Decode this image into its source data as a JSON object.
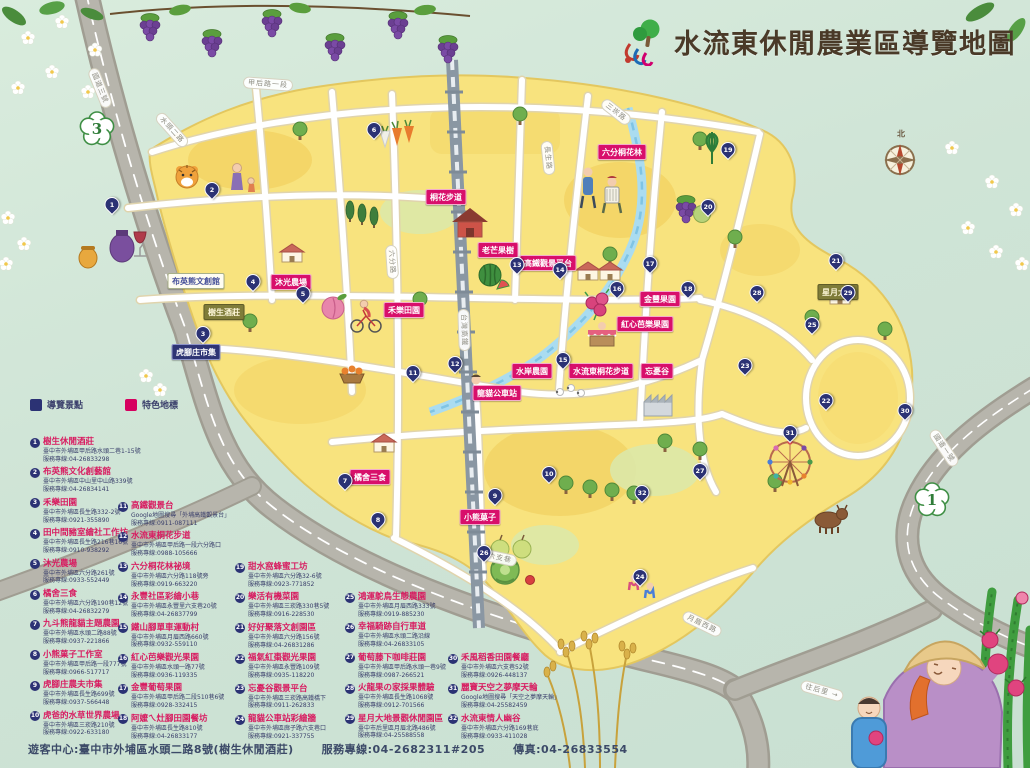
{
  "header": {
    "title": "水流東休閒農業區導覽地圖",
    "logo": "tree-and-water-swirl-logo"
  },
  "compass": {
    "north_label": "北"
  },
  "highway_shields": [
    {
      "num": "3",
      "x": 97,
      "y": 129
    },
    {
      "num": "1",
      "x": 932,
      "y": 500
    }
  ],
  "road_labels": [
    {
      "text": "國道三號",
      "x": 100,
      "y": 88,
      "rot": 68
    },
    {
      "text": "甲后路一段",
      "x": 268,
      "y": 84,
      "rot": 4
    },
    {
      "text": "水頭二路",
      "x": 172,
      "y": 130,
      "rot": 48
    },
    {
      "text": "六分路",
      "x": 392,
      "y": 262,
      "rot": 86
    },
    {
      "text": "長生路",
      "x": 548,
      "y": 158,
      "rot": 84
    },
    {
      "text": "三崁路",
      "x": 616,
      "y": 112,
      "rot": 38
    },
    {
      "text": "台灣高鐵",
      "x": 464,
      "y": 330,
      "rot": 88
    },
    {
      "text": "六支巷",
      "x": 500,
      "y": 558,
      "rot": 12
    },
    {
      "text": "月眉西路",
      "x": 702,
      "y": 624,
      "rot": 26
    },
    {
      "text": "往后里 →",
      "x": 822,
      "y": 691,
      "rot": 16
    },
    {
      "text": "國道一號",
      "x": 944,
      "y": 448,
      "rot": 56
    }
  ],
  "map_labels": [
    {
      "text": "布英熊文創館",
      "x": 196,
      "y": 281,
      "style": "white"
    },
    {
      "text": "樹生酒莊",
      "x": 224,
      "y": 312,
      "style": "olive"
    },
    {
      "text": "虎腳庄市集",
      "x": 196,
      "y": 352,
      "style": "navy"
    },
    {
      "text": "沐光農場",
      "x": 291,
      "y": 282,
      "style": "pink"
    },
    {
      "text": "禾樂田園",
      "x": 404,
      "y": 310,
      "style": "pink"
    },
    {
      "text": "桐花步道",
      "x": 446,
      "y": 197,
      "style": "pink"
    },
    {
      "text": "老芒果樹",
      "x": 498,
      "y": 250,
      "style": "pink"
    },
    {
      "text": "高鐵觀景平台",
      "x": 548,
      "y": 263,
      "style": "pink"
    },
    {
      "text": "六分桐花林",
      "x": 622,
      "y": 152,
      "style": "pink"
    },
    {
      "text": "金豐果園",
      "x": 660,
      "y": 299,
      "style": "pink"
    },
    {
      "text": "紅心芭樂果園",
      "x": 645,
      "y": 324,
      "style": "pink"
    },
    {
      "text": "水岸農園",
      "x": 532,
      "y": 371,
      "style": "pink"
    },
    {
      "text": "水流東桐花步道",
      "x": 601,
      "y": 371,
      "style": "pink"
    },
    {
      "text": "忘憂谷",
      "x": 657,
      "y": 371,
      "style": "pink"
    },
    {
      "text": "龍貓公車站",
      "x": 497,
      "y": 393,
      "style": "pink"
    },
    {
      "text": "橘舍三食",
      "x": 370,
      "y": 477,
      "style": "pink"
    },
    {
      "text": "小熊菓子",
      "x": 480,
      "y": 517,
      "style": "pink"
    },
    {
      "text": "星月大地",
      "x": 838,
      "y": 292,
      "style": "olive"
    }
  ],
  "pins": [
    {
      "n": 1,
      "x": 112,
      "y": 212
    },
    {
      "n": 2,
      "x": 212,
      "y": 197
    },
    {
      "n": 3,
      "x": 203,
      "y": 341
    },
    {
      "n": 4,
      "x": 253,
      "y": 289
    },
    {
      "n": 5,
      "x": 303,
      "y": 301
    },
    {
      "n": 6,
      "x": 374,
      "y": 137
    },
    {
      "n": 7,
      "x": 345,
      "y": 488
    },
    {
      "n": 8,
      "x": 378,
      "y": 527
    },
    {
      "n": 9,
      "x": 495,
      "y": 503
    },
    {
      "n": 10,
      "x": 549,
      "y": 481
    },
    {
      "n": 11,
      "x": 413,
      "y": 380
    },
    {
      "n": 12,
      "x": 455,
      "y": 371
    },
    {
      "n": 13,
      "x": 517,
      "y": 272
    },
    {
      "n": 14,
      "x": 560,
      "y": 277
    },
    {
      "n": 15,
      "x": 563,
      "y": 367
    },
    {
      "n": 16,
      "x": 617,
      "y": 296
    },
    {
      "n": 17,
      "x": 650,
      "y": 271
    },
    {
      "n": 18,
      "x": 688,
      "y": 296
    },
    {
      "n": 19,
      "x": 728,
      "y": 157
    },
    {
      "n": 20,
      "x": 708,
      "y": 214
    },
    {
      "n": 21,
      "x": 836,
      "y": 268
    },
    {
      "n": 22,
      "x": 826,
      "y": 408
    },
    {
      "n": 23,
      "x": 745,
      "y": 373
    },
    {
      "n": 24,
      "x": 640,
      "y": 584
    },
    {
      "n": 25,
      "x": 812,
      "y": 332
    },
    {
      "n": 26,
      "x": 484,
      "y": 560
    },
    {
      "n": 27,
      "x": 700,
      "y": 478
    },
    {
      "n": 28,
      "x": 757,
      "y": 300
    },
    {
      "n": 29,
      "x": 848,
      "y": 300
    },
    {
      "n": 30,
      "x": 905,
      "y": 418
    },
    {
      "n": 31,
      "x": 790,
      "y": 440
    },
    {
      "n": 32,
      "x": 642,
      "y": 500
    }
  ],
  "legend": {
    "keys": [
      {
        "label": "導覽景點",
        "color": "#2b3274"
      },
      {
        "label": "特色地標",
        "color": "#d6005f"
      }
    ],
    "row_height": 30.4,
    "columns": [
      {
        "x": 30,
        "y": 437,
        "items": [
          {
            "n": 1,
            "title": "樹生休閒酒莊",
            "addr": "臺中市外埔區甲后路水頭二巷1-15號",
            "tel": "服務專線:04-26833298"
          },
          {
            "n": 2,
            "title": "布英熊文化創藝館",
            "addr": "臺中市外埔區中山里中山路339號",
            "tel": "服務專線:04-26834141"
          },
          {
            "n": 3,
            "title": "禾樂田園",
            "addr": "臺中市外埔區長生路332-2號",
            "tel": "服務專線:0921-355890"
          },
          {
            "n": 4,
            "title": "田中間豬室繪社工作坊",
            "addr": "臺中市外埔區長生路216巷16號",
            "tel": "服務專線:0910-938292"
          },
          {
            "n": 5,
            "title": "沐光農場",
            "addr": "臺中市外埔區六分路261號",
            "tel": "服務專線:0933-552449"
          },
          {
            "n": 6,
            "title": "橘舍三食",
            "addr": "臺中市外埔區六分路190巷12號",
            "tel": "服務專線:04-26832279"
          },
          {
            "n": 7,
            "title": "九斗熊龍貓主題農園",
            "addr": "臺中市外埔區水頭二路88號",
            "tel": "服務專線:0937-221866"
          },
          {
            "n": 8,
            "title": "小熊菓子工作室",
            "addr": "臺中市外埔區甲后路一段777號",
            "tel": "服務專線:0966-517717"
          },
          {
            "n": 9,
            "title": "虎腳庄農夫市集",
            "addr": "臺中市外埔區長生路699號",
            "tel": "服務專線:0937-566448"
          },
          {
            "n": 10,
            "title": "虎爸的水草世界農場",
            "addr": "臺中市外埔區三崁路210號",
            "tel": "服務專線:0922-633180"
          }
        ]
      },
      {
        "x": 118,
        "y": 501,
        "items": [
          {
            "n": 11,
            "title": "高鐵觀景台",
            "addr": "Google地圖搜尋「外埔高鐵觀景台」",
            "tel": "服務專線:0911-087111"
          },
          {
            "n": 12,
            "title": "水流東桐花步道",
            "addr": "臺中市外埔區甲后路一段六分路口",
            "tel": "服務專線:0988-105666"
          },
          {
            "n": 13,
            "title": "六分桐花林祕境",
            "addr": "臺中市外埔區六分路118號旁",
            "tel": "服務專線:0919-663220"
          },
          {
            "n": 14,
            "title": "永豐社區彩繪小巷",
            "addr": "臺中市外埔區永豐里六支巷20號",
            "tel": "服務專線:04-26837799"
          },
          {
            "n": 15,
            "title": "鐵山腳單車運動村",
            "addr": "臺中市外埔區月眉西路660號",
            "tel": "服務專線:0932-559110"
          },
          {
            "n": 16,
            "title": "紅心芭樂觀光果園",
            "addr": "臺中市外埔區水頭一路77號",
            "tel": "服務專線:0936-119335"
          },
          {
            "n": 17,
            "title": "金豐葡萄果園",
            "addr": "臺中市外埔區甲后路二段510巷6號",
            "tel": "服務專線:0928-332415"
          },
          {
            "n": 18,
            "title": "阿嬤ㄟ灶腳田園餐坊",
            "addr": "臺中市外埔區長生路810號",
            "tel": "服務專線:04-26833177"
          }
        ]
      },
      {
        "x": 235,
        "y": 562,
        "items": [
          {
            "n": 19,
            "title": "甜水窩蜂蜜工坊",
            "addr": "臺中市外埔區六分路32-6號",
            "tel": "服務專線:0923-771852"
          },
          {
            "n": 20,
            "title": "樂活有機菜園",
            "addr": "臺中市外埔區三崁路330巷5號",
            "tel": "服務專線:0916-228530"
          },
          {
            "n": 21,
            "title": "好好聚落文創園區",
            "addr": "臺中市外埔區六分路156號",
            "tel": "服務專線:04-26831286"
          },
          {
            "n": 22,
            "title": "福氣紅棗觀光果園",
            "addr": "臺中市外埔區永豐路109號",
            "tel": "服務專線:0935-118220"
          },
          {
            "n": 23,
            "title": "忘憂谷觀景平台",
            "addr": "臺中市外埔區三崁路高鐵橋下",
            "tel": "服務專線:0911-262833"
          },
          {
            "n": 24,
            "title": "龍貓公車站彩繪牆",
            "addr": "臺中市外埔區廍子路六支巷口",
            "tel": "服務專線:0921-337755"
          }
        ]
      },
      {
        "x": 345,
        "y": 592,
        "items": [
          {
            "n": 25,
            "title": "鴻運鴕鳥生態農園",
            "addr": "臺中市外埔區月眉西路333號",
            "tel": "服務專線:0919-885230"
          },
          {
            "n": 26,
            "title": "幸福騎跡自行車道",
            "addr": "臺中市外埔區水頭二路沿線",
            "tel": "服務專線:04-26833105"
          },
          {
            "n": 27,
            "title": "葡萄藤下咖啡莊園",
            "addr": "臺中市外埔區甲后路水頭一巷9號",
            "tel": "服務專線:0987-266521"
          },
          {
            "n": 28,
            "title": "火龍果の家採果體驗",
            "addr": "臺中市外埔區長生路1068號",
            "tel": "服務專線:0912-701566"
          },
          {
            "n": 29,
            "title": "星月大地景觀休閒園區",
            "addr": "臺中市后里區月眉北路486號",
            "tel": "服務專線:04-25588558"
          }
        ]
      },
      {
        "x": 448,
        "y": 653,
        "items": [
          {
            "n": 30,
            "title": "禾風稻香田園餐廳",
            "addr": "臺中市外埔區六支巷52號",
            "tel": "服務專線:0926-448137"
          },
          {
            "n": 31,
            "title": "麗寶天空之夢摩天輪",
            "addr": "Google地圖搜尋「天空之夢摩天輪」",
            "tel": "服務專線:04-25582459"
          },
          {
            "n": 32,
            "title": "水流東情人幽谷",
            "addr": "臺中市外埔區六分路169巷底",
            "tel": "服務專線:0933-411028"
          }
        ]
      }
    ]
  },
  "footer": {
    "visitor_center": "遊客中心:臺中市外埔區水頭二路8號(樹生休閒酒莊)",
    "hotline": "服務專線:04-2682311#205",
    "fax": "傳真:04-26833554"
  },
  "colors": {
    "background_mint": "#cfe4d6",
    "land_yellow": "#f8e37e",
    "pin_navy": "#2b3274",
    "badge_magenta": "#d80f6b",
    "title_brown": "#4a3a28",
    "freeway_gray": "#b7b5ac",
    "creek_blue": "#aadcf0"
  }
}
